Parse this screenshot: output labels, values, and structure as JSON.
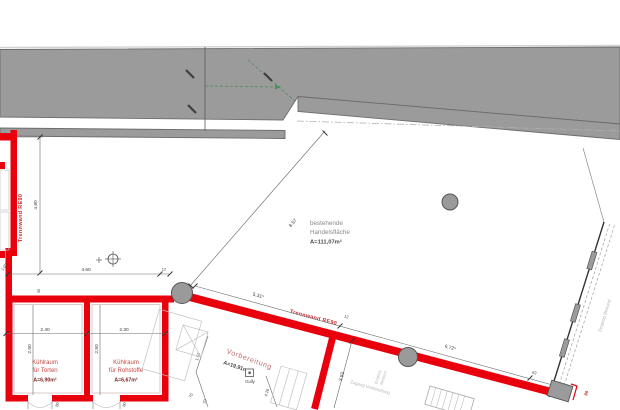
{
  "plan": {
    "rooms": {
      "handelsflaeche": {
        "line1": "bestehende",
        "line2": "Handelsfläche",
        "area": "A=111,07m²"
      },
      "kuehlraum_torten": {
        "line1": "Kühlraum",
        "line2": "für Torten",
        "area": "A=6,90m²"
      },
      "kuehlraum_rohstoffe": {
        "line1": "Kühlraum",
        "line2": "für Rohstoffe",
        "area": "A=6,67m²"
      },
      "vorbereitung": {
        "name": "Vorbereitung",
        "area": "A=19,91m²"
      }
    },
    "walls": {
      "trennwand_left": "Trennwand RE90",
      "trennwand_diag": "Trennwand RE90"
    },
    "annotations": {
      "gully": "Gully",
      "zugang": "Zugang Vorbereitung",
      "eingang_line1": "Eingang",
      "eingang_line2": "Bestand",
      "eingang_bestand": "Eingang Bestand"
    },
    "dimensions": {
      "d480": "4.80",
      "d460": "4.60",
      "d12a": "12",
      "d102": "1.02",
      "d35": "35",
      "d531": "5.31⁵",
      "d12b": "12",
      "d672": "6.72⁵",
      "d63": "63",
      "d857": "8.57",
      "d240": "2.40",
      "d230": "2.30",
      "d290a": "2.90",
      "d290b": "2.90",
      "d393": "3.93",
      "d152": "1.52",
      "d426": "4.26",
      "d70a": "70",
      "d70b": "70",
      "d80a": "80",
      "d80b": "80",
      "d90": "90"
    },
    "colors": {
      "wall_red": "#e8000d",
      "existing_gray": "#9b9b9b",
      "dimension_text": "#3c3c3c",
      "green_guide": "#4c8f5c"
    }
  }
}
